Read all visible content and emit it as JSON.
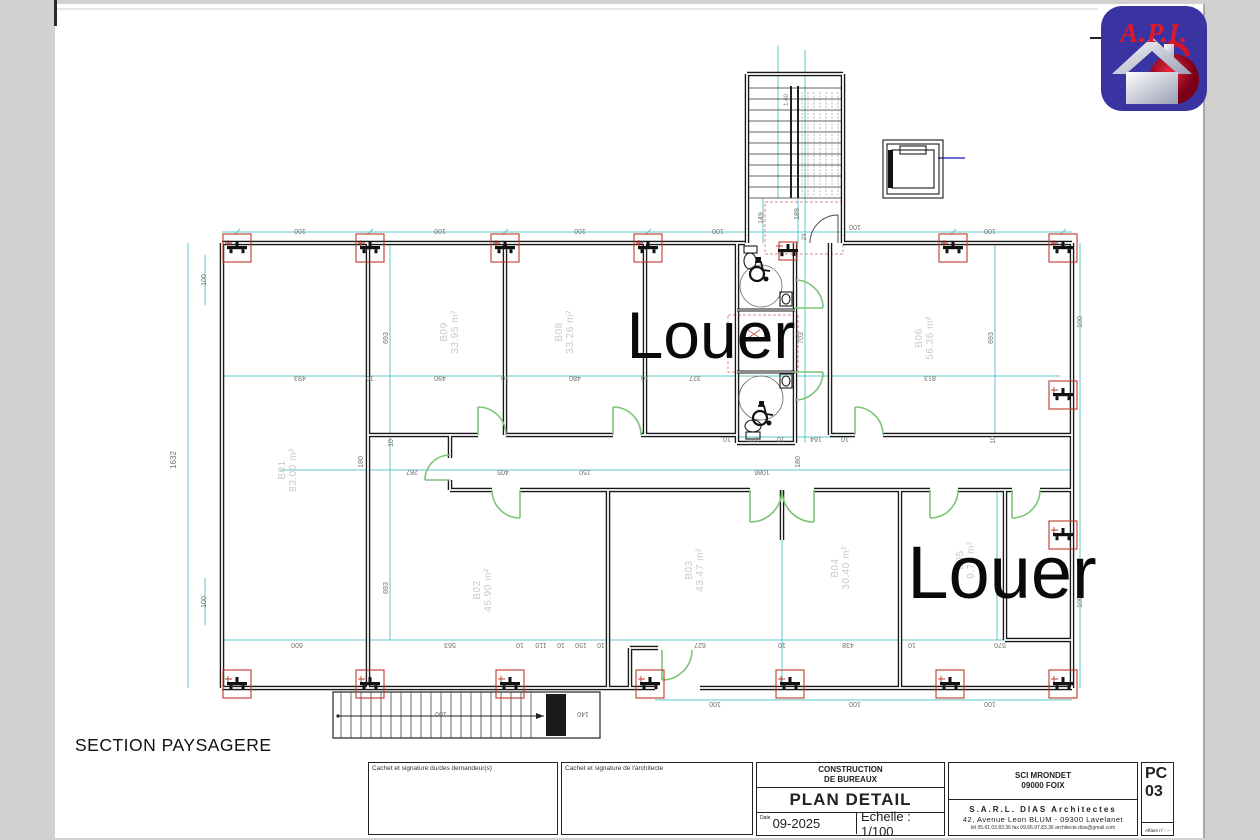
{
  "colors": {
    "wall": "#181818",
    "dim_line": "#5fc8ce",
    "door_green": "#7cc576",
    "column_red": "#c0392b",
    "dim_text": "#6f6f6f",
    "room_label": "#c9c9c9",
    "louer": "#0a0a0a",
    "logo_bg": "#3a34a3",
    "logo_text": "#e01828"
  },
  "logo": {
    "text": "A.P.I."
  },
  "section_label": "SECTION PAYSAGERE",
  "plan": {
    "louer": [
      {
        "t": "Louer",
        "x": 711,
        "y": 358,
        "size": 66
      },
      {
        "t": "Louer",
        "x": 1002,
        "y": 598,
        "size": 74
      }
    ],
    "rooms": [
      {
        "id": "B01",
        "area": "83.00 m²",
        "x": 285,
        "y": 470
      },
      {
        "id": "B09",
        "area": "33.95 m²",
        "x": 447,
        "y": 332
      },
      {
        "id": "B08",
        "area": "33.26 m²",
        "x": 562,
        "y": 332
      },
      {
        "id": "B06",
        "area": "56.36 m²",
        "x": 922,
        "y": 338
      },
      {
        "id": "B02",
        "area": "45.90 m²",
        "x": 480,
        "y": 590
      },
      {
        "id": "B03",
        "area": "43.47 m²",
        "x": 692,
        "y": 570
      },
      {
        "id": "B04",
        "area": "30.40 m²",
        "x": 838,
        "y": 568
      },
      {
        "id": "B05",
        "area": "9.70 m²",
        "x": 963,
        "y": 560
      }
    ],
    "dims": [
      {
        "t": "100",
        "x": 300,
        "y": 229,
        "r": 180
      },
      {
        "t": "100",
        "x": 440,
        "y": 229,
        "r": 180
      },
      {
        "t": "100",
        "x": 580,
        "y": 229,
        "r": 180
      },
      {
        "t": "100",
        "x": 718,
        "y": 229,
        "r": 180
      },
      {
        "t": "100",
        "x": 855,
        "y": 225,
        "r": 180
      },
      {
        "t": "100",
        "x": 990,
        "y": 229,
        "r": 180
      },
      {
        "t": "493",
        "x": 300,
        "y": 376,
        "r": 180
      },
      {
        "t": "10",
        "x": 370,
        "y": 376,
        "r": 180
      },
      {
        "t": "490",
        "x": 440,
        "y": 376,
        "r": 180
      },
      {
        "t": "10",
        "x": 505,
        "y": 376,
        "r": 180
      },
      {
        "t": "480",
        "x": 575,
        "y": 376,
        "r": 180
      },
      {
        "t": "10",
        "x": 645,
        "y": 376,
        "r": 180
      },
      {
        "t": "327",
        "x": 695,
        "y": 376,
        "r": 180
      },
      {
        "t": "813",
        "x": 930,
        "y": 376,
        "r": 180
      },
      {
        "t": "10",
        "x": 727,
        "y": 437,
        "r": 180
      },
      {
        "t": "177",
        "x": 753,
        "y": 437,
        "r": 180
      },
      {
        "t": "10",
        "x": 781,
        "y": 437,
        "r": 180
      },
      {
        "t": "164",
        "x": 816,
        "y": 437,
        "r": 180
      },
      {
        "t": "10",
        "x": 845,
        "y": 437,
        "r": 180
      },
      {
        "t": "287",
        "x": 412,
        "y": 470,
        "r": 180
      },
      {
        "t": "405",
        "x": 503,
        "y": 470,
        "r": 180
      },
      {
        "t": "150",
        "x": 585,
        "y": 470,
        "r": 180
      },
      {
        "t": "1086",
        "x": 762,
        "y": 470,
        "r": 180
      },
      {
        "t": "600",
        "x": 297,
        "y": 643,
        "r": 180
      },
      {
        "t": "563",
        "x": 450,
        "y": 643,
        "r": 180
      },
      {
        "t": "10",
        "x": 520,
        "y": 643,
        "r": 180
      },
      {
        "t": "110",
        "x": 541,
        "y": 643,
        "r": 180
      },
      {
        "t": "10",
        "x": 561,
        "y": 643,
        "r": 180
      },
      {
        "t": "150",
        "x": 581,
        "y": 643,
        "r": 180
      },
      {
        "t": "10",
        "x": 601,
        "y": 643,
        "r": 180
      },
      {
        "t": "627",
        "x": 700,
        "y": 643,
        "r": 180
      },
      {
        "t": "10",
        "x": 782,
        "y": 643,
        "r": 180
      },
      {
        "t": "438",
        "x": 848,
        "y": 643,
        "r": 180
      },
      {
        "t": "10",
        "x": 912,
        "y": 643,
        "r": 180
      },
      {
        "t": "570",
        "x": 1000,
        "y": 643,
        "r": 180
      },
      {
        "t": "100",
        "x": 715,
        "y": 702,
        "r": 180
      },
      {
        "t": "100",
        "x": 855,
        "y": 702,
        "r": 180
      },
      {
        "t": "100",
        "x": 990,
        "y": 702,
        "r": 180
      },
      {
        "t": "100",
        "x": 441,
        "y": 712,
        "r": 180
      },
      {
        "t": "140",
        "x": 583,
        "y": 712,
        "r": 180
      },
      {
        "t": "1632",
        "x": 176,
        "y": 460,
        "r": -90,
        "s": 8
      },
      {
        "t": "100",
        "x": 206,
        "y": 280,
        "r": -90
      },
      {
        "t": "100",
        "x": 206,
        "y": 602,
        "r": -90
      },
      {
        "t": "693",
        "x": 388,
        "y": 338,
        "r": -90
      },
      {
        "t": "703",
        "x": 803,
        "y": 338,
        "r": -90
      },
      {
        "t": "693",
        "x": 993,
        "y": 338,
        "r": -90
      },
      {
        "t": "693",
        "x": 388,
        "y": 588,
        "r": -90
      },
      {
        "t": "180",
        "x": 363,
        "y": 462,
        "r": -90
      },
      {
        "t": "180",
        "x": 800,
        "y": 462,
        "r": -90
      },
      {
        "t": "10",
        "x": 393,
        "y": 443,
        "r": -90
      },
      {
        "t": "10",
        "x": 995,
        "y": 440,
        "r": -90
      },
      {
        "t": "100",
        "x": 1082,
        "y": 322,
        "r": -90
      },
      {
        "t": "100",
        "x": 1082,
        "y": 602,
        "r": -90
      },
      {
        "t": "149",
        "x": 763,
        "y": 218,
        "r": -90
      },
      {
        "t": "189",
        "x": 799,
        "y": 214,
        "r": -90
      },
      {
        "t": "23",
        "x": 806,
        "y": 237,
        "r": -90,
        "s": 6
      },
      {
        "t": "1.40",
        "x": 788,
        "y": 100,
        "r": -90,
        "s": 6
      }
    ],
    "columns": [
      {
        "x": 237,
        "y": 248
      },
      {
        "x": 370,
        "y": 248
      },
      {
        "x": 505,
        "y": 248
      },
      {
        "x": 648,
        "y": 248
      },
      {
        "x": 953,
        "y": 248
      },
      {
        "x": 1063,
        "y": 248
      },
      {
        "x": 237,
        "y": 684
      },
      {
        "x": 370,
        "y": 684
      },
      {
        "x": 510,
        "y": 684
      },
      {
        "x": 650,
        "y": 684
      },
      {
        "x": 790,
        "y": 684
      },
      {
        "x": 950,
        "y": 684
      },
      {
        "x": 1063,
        "y": 684
      },
      {
        "x": 1063,
        "y": 395
      },
      {
        "x": 1063,
        "y": 535
      },
      {
        "x": 788,
        "y": 251,
        "s": 18
      }
    ]
  },
  "title_block": {
    "cachet_demandeur": "Cachet et signature du/des demandeur(s)",
    "cachet_architecte": "Cachet et signature de l'architecte",
    "project_line1": "CONSTRUCTION",
    "project_line2": "DE BUREAUX",
    "doc_title": "PLAN DETAIL",
    "date_label": "Date",
    "date_value": "09-2025",
    "scale_value": "Echelle : 1/100",
    "client_line1": "SCI MRONDET",
    "client_line2": "09000 FOIX",
    "firm_name": "S.A.R.L. DIAS Architectes",
    "firm_address": "42, Avenue Leon BLUM - 09300 Lavelanet",
    "firm_contact": "tél 05.61.03.83.36   fax 09.66.97.83.36   architecte.dias@gmail.com",
    "code_line1": "PC",
    "code_line2": "03",
    "affaire": "Affaire n° : –"
  }
}
